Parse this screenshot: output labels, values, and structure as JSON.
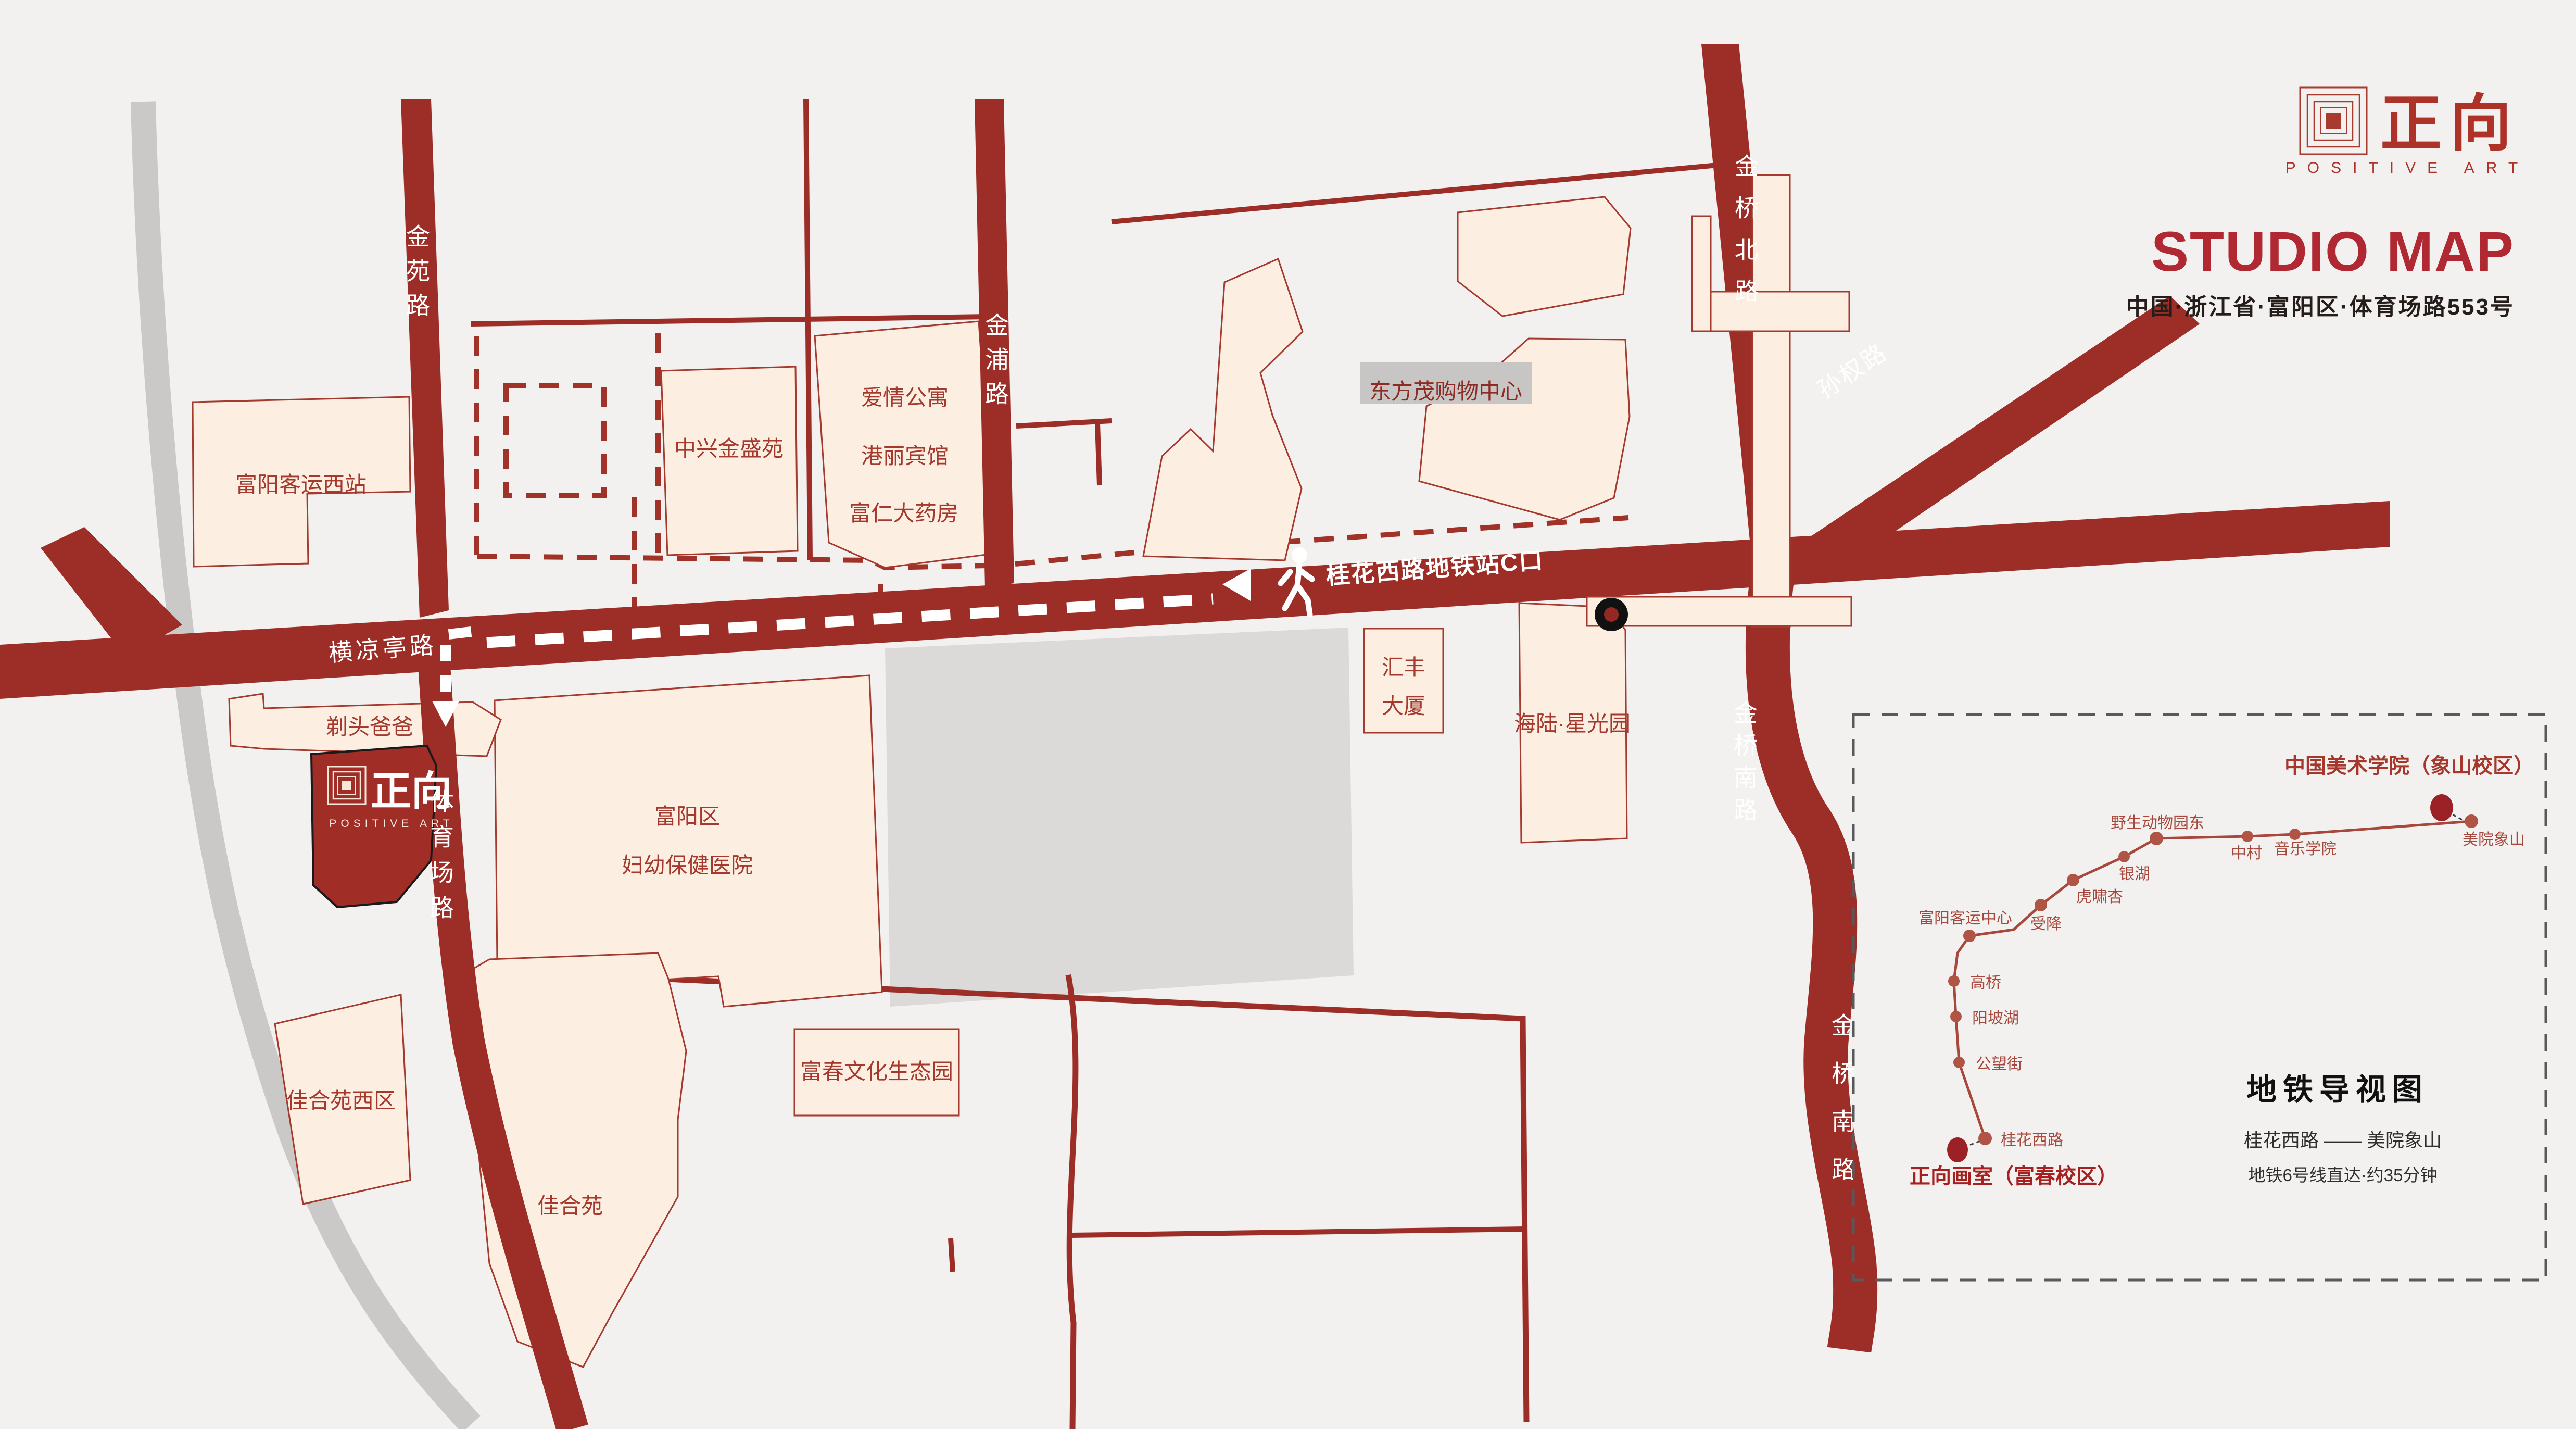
{
  "brand": {
    "logo_cn": "正向",
    "logo_en": "POSITIVE ART"
  },
  "header": {
    "title": "STUDIO MAP",
    "address": "中国·浙江省·富阳区·体育场路553号"
  },
  "map": {
    "roads": {
      "jinyuan": "金苑路",
      "jinpu": "金浦路",
      "jinqiao_north": "金桥北路",
      "sunquan": "孙权路",
      "jinqiao_south": "金桥南路",
      "hengliangting": "横凉亭路",
      "tiyuchang": "体育场路"
    },
    "route_label": "桂花西路地铁站C口",
    "buildings": {
      "fuyang_west": "富阳客运西站",
      "zhongxing": "中兴金盛苑",
      "aiqing": "爱情公寓",
      "gangli": "港丽宾馆",
      "furen": "富仁大药房",
      "dongfangmao": "东方茂购物中心",
      "huifeng": {
        "lines": [
          "汇丰",
          "大厦"
        ]
      },
      "hailu": "海陆·星光园",
      "fuyou": {
        "lines": [
          "富阳区",
          "妇幼保健医院"
        ]
      },
      "titoubaba": "剃头爸爸",
      "jiaheyuan_xi": "佳合苑西区",
      "jiaheyuan": "佳合苑",
      "fuchun": "富春文化生态园"
    },
    "studio": {
      "cn": "正向",
      "en": "POSITIVE ART"
    },
    "icons": {
      "pedestrian": "walking-person",
      "direction_west": "arrow-left",
      "direction_south": "arrow-down",
      "metro_exit": "black-dot-marker"
    }
  },
  "metro": {
    "title": "地铁导视图",
    "destination": "中国美术学院（象山校区）",
    "origin": "正向画室（富春校区）",
    "route": "桂花西路 —— 美院象山",
    "note": "地铁6号线直达·约35分钟",
    "stations": [
      "桂花西路",
      "公望街",
      "阳坡湖",
      "高桥",
      "富阳客运中心",
      "受降",
      "虎啸杏",
      "银湖",
      "野生动物园东",
      "中村",
      "音乐学院",
      "美院象山"
    ]
  }
}
